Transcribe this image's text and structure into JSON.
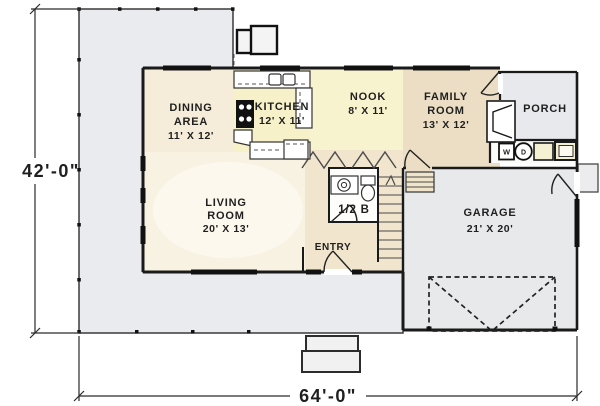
{
  "plan": {
    "dimension_labels": {
      "left": "42'-0\"",
      "bottom": "64'-0\""
    },
    "rooms": {
      "dining": {
        "name_line1": "DINING",
        "name_line2": "AREA",
        "size": "11' X 12'"
      },
      "kitchen": {
        "name": "KITCHEN",
        "size": "12' X 11'"
      },
      "nook": {
        "name": "NOOK",
        "size": "8' X 11'"
      },
      "family_room": {
        "name_line1": "FAMILY",
        "name_line2": "ROOM",
        "size": "13' X 12'"
      },
      "porch": {
        "name": "PORCH"
      },
      "living_room": {
        "name_line1": "LIVING",
        "name_line2": "ROOM",
        "size": "20' X 13'"
      },
      "half_bath": {
        "name": "1/2 B"
      },
      "entry": {
        "name": "ENTRY"
      },
      "garage": {
        "name": "GARAGE",
        "size": "21' X 20'"
      }
    },
    "appliances": {
      "washer": "W",
      "dryer": "D"
    },
    "colors": {
      "deck": "#e9ebee",
      "dining": "#f5ecd9",
      "kitchen": "#f6f1c8",
      "nook": "#f8f3cf",
      "family_room": "#ebdec4",
      "porch": "#e7e9ec",
      "living_room": "#f8f2e3",
      "hall": "#f1e6cd",
      "garage": "#e7e9eb",
      "closet": "#f5efd3",
      "bath": "#fdfdfb",
      "wall": "#1a1a1a"
    }
  }
}
